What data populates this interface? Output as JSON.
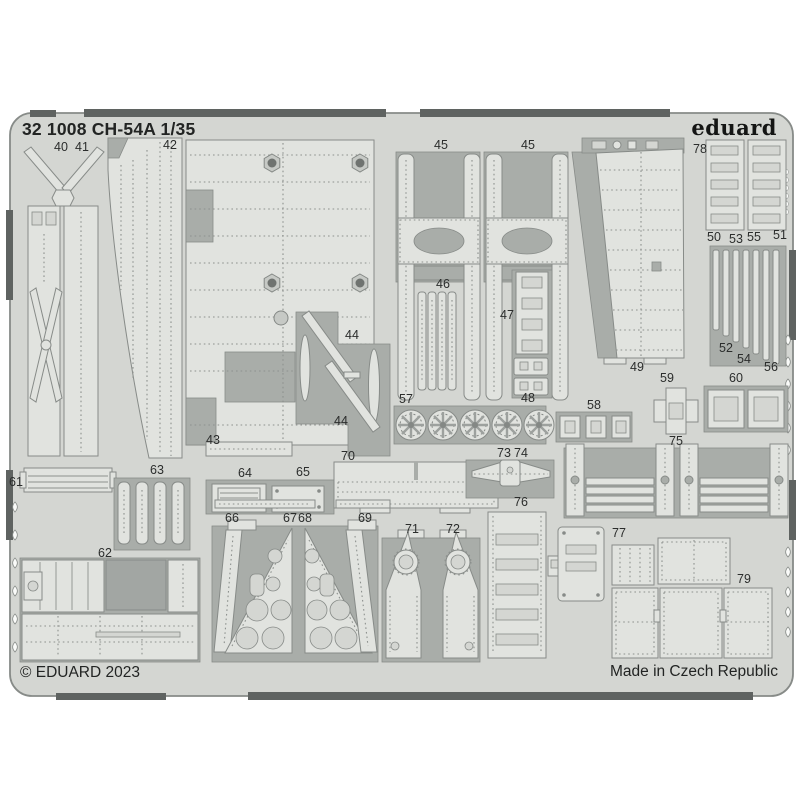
{
  "sheet": {
    "header": "32 1008 CH-54A 1/35",
    "brand": "eduard",
    "copyright": "© EDUARD 2023",
    "made_in": "Made in Czech Republic",
    "colors": {
      "bg": "#ffffff",
      "plate": "#d4d6d2",
      "part": "#e1e3df",
      "waste": "#a9ada9",
      "edge": "#5f6361",
      "line": "#878b88",
      "ink": "#222423"
    },
    "part_labels": [
      {
        "n": "40",
        "x": 61,
        "y": 152
      },
      {
        "n": "41",
        "x": 82,
        "y": 152
      },
      {
        "n": "42",
        "x": 170,
        "y": 150
      },
      {
        "n": "45",
        "x": 441,
        "y": 150
      },
      {
        "n": "45",
        "x": 528,
        "y": 150
      },
      {
        "n": "78",
        "x": 700,
        "y": 154
      },
      {
        "n": "50",
        "x": 714,
        "y": 242
      },
      {
        "n": "53",
        "x": 736,
        "y": 244
      },
      {
        "n": "55",
        "x": 754,
        "y": 242
      },
      {
        "n": "51",
        "x": 780,
        "y": 240
      },
      {
        "n": "46",
        "x": 443,
        "y": 289
      },
      {
        "n": "47",
        "x": 507,
        "y": 320
      },
      {
        "n": "52",
        "x": 726,
        "y": 353
      },
      {
        "n": "54",
        "x": 744,
        "y": 364
      },
      {
        "n": "56",
        "x": 771,
        "y": 372
      },
      {
        "n": "44",
        "x": 352,
        "y": 340
      },
      {
        "n": "44",
        "x": 341,
        "y": 426
      },
      {
        "n": "43",
        "x": 213,
        "y": 445
      },
      {
        "n": "49",
        "x": 637,
        "y": 372
      },
      {
        "n": "48",
        "x": 528,
        "y": 403
      },
      {
        "n": "57",
        "x": 406,
        "y": 404
      },
      {
        "n": "58",
        "x": 594,
        "y": 410
      },
      {
        "n": "59",
        "x": 667,
        "y": 383
      },
      {
        "n": "60",
        "x": 736,
        "y": 383
      },
      {
        "n": "75",
        "x": 676,
        "y": 446
      },
      {
        "n": "61",
        "x": 16,
        "y": 487
      },
      {
        "n": "63",
        "x": 157,
        "y": 475
      },
      {
        "n": "64",
        "x": 245,
        "y": 478
      },
      {
        "n": "65",
        "x": 303,
        "y": 477
      },
      {
        "n": "70",
        "x": 348,
        "y": 461
      },
      {
        "n": "73",
        "x": 504,
        "y": 458
      },
      {
        "n": "74",
        "x": 521,
        "y": 458
      },
      {
        "n": "62",
        "x": 105,
        "y": 558
      },
      {
        "n": "66",
        "x": 232,
        "y": 523
      },
      {
        "n": "67",
        "x": 290,
        "y": 523
      },
      {
        "n": "68",
        "x": 305,
        "y": 523
      },
      {
        "n": "69",
        "x": 365,
        "y": 523
      },
      {
        "n": "71",
        "x": 412,
        "y": 534
      },
      {
        "n": "72",
        "x": 453,
        "y": 534
      },
      {
        "n": "76",
        "x": 521,
        "y": 507
      },
      {
        "n": "77",
        "x": 619,
        "y": 538
      },
      {
        "n": "79",
        "x": 744,
        "y": 584
      }
    ]
  }
}
